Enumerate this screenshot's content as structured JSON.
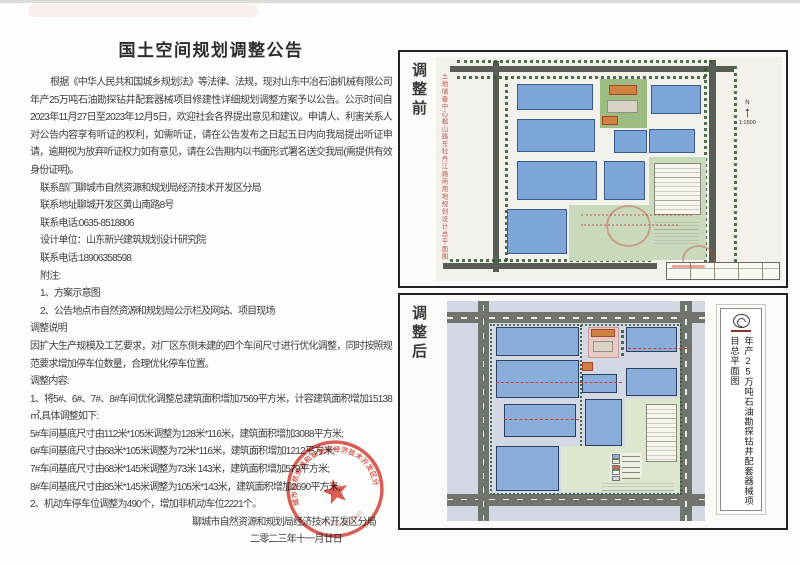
{
  "announcement": {
    "title": "国土空间规划调整公告",
    "para1": "根据《中华人民共和国城乡规划法》等法律、法规，现对山东中冶石油机械有限公司年产25万吨石油勘探钻井配套器械项目修建性详细规划调整方案予以公告。公示时间自2023年11月27日至2023年12月5日，欢迎社会各界提出意见和建议。申请人、利害关系人对公告内容享有听证的权利，如需听证，请在公告发布之日起五日内向我局提出听证申请，逾期视为放弃听证权力如有意见，请在公告期内以书面形式署名送交我局(需提供有效身份证明)。",
    "lines": {
      "dept": "联系部门聊城市自然资源和规划局经济技术开发区分局",
      "addr": "联系地址聊城开发区黄山南路8号",
      "phone1": "联系电话:0635-8518806",
      "designer": "设计单位：山东新兴建筑规划设计研究院",
      "phone2": "联系电话:18906358598",
      "notes_label": "附注:",
      "note1": "1、方案示意图",
      "note2": "2、公告地点市自然资源和规划局公示栏及网站、项目现场",
      "adjust_note_label": "调整说明",
      "adjust_note": "因扩大生产规模及工艺要求，对厂区东侧未建的四个车间尺寸进行优化调整，同时按照规范要求增加停车位数量，合理优化停车位置。",
      "adjust_content_label": "调整内容:",
      "item1": "1、将5#、6#、7#、8#车间优化调整总建筑面积增加7569平方米，计容建筑面积增加15138㎡,具体调整如下:",
      "w5": "5#车间基底尺寸由112米*105米调整为128米*116米，建筑面积增加3088平方米;",
      "w6": "6#车间基底尺寸由68米*105米调整为72米*116米，建筑面积增加1212平方米;",
      "w7": "7#车间基底尺寸由68米*145米调整为73米 143米，建筑面积增加579平方米;",
      "w8": "8#车间基底尺寸由85米*145米调整为105米*143米，建筑面积增加2690平方米;",
      "item2": "2、机动车停车位调整为490个，增加非机动车位2221个。",
      "signature": "聊城市自然资源和规划局经济技术开发区分局",
      "date": "二零二三年十一月廿日"
    },
    "seal": {
      "ring_text": "聊城市自然资源和规划局经济技术开发区分局",
      "number": "3715002007420"
    }
  },
  "panels": {
    "before": {
      "label": "调整前",
      "side_caption": "土地储备中心都山路东牡丹江路南用地规划设计总平面图",
      "north": "N",
      "scale": "1:1500"
    },
    "after": {
      "label": "调整后",
      "plan_title": "年产25万吨石油勘探钻井配套器械项目总平面图"
    }
  },
  "colors": {
    "building_blue_before": "#7da6d8",
    "building_blue_after": "#8badda",
    "road_dark": "#585d55",
    "road_light": "#6f746d",
    "green_area_before": "#c9dabc",
    "green_area_after": "#dde7cf",
    "surround_lavender": "#d4d8e4",
    "tree_green": "#2f5a2d",
    "seal_red": "#d23b30",
    "caption_red": "#bb5a50",
    "dashed_red": "#c84335"
  }
}
